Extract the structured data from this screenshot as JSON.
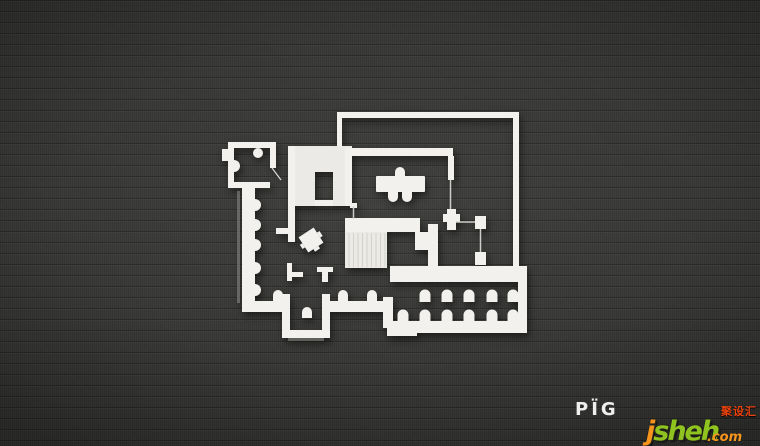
{
  "scene": {
    "background_color": "#3b3b39",
    "plan_wall_color": "#f2f1ee",
    "plan_floor_color": "#343432"
  },
  "brand": {
    "logo_text": "PÏG",
    "logo_color": "#efefed"
  },
  "watermark": {
    "j": "j",
    "sheh": "sheh",
    "dot_com": ".com",
    "cjk": "聚设汇",
    "j_color": "#f7941d",
    "sheh_color": "#8fc320",
    "com_color": "#f7941d",
    "cjk_color": "#e8420d"
  }
}
